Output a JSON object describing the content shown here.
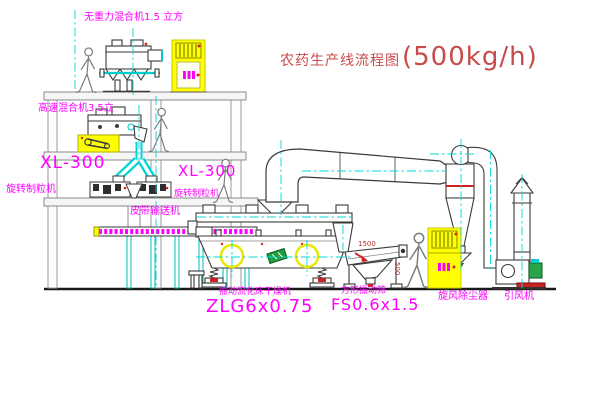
{
  "title": {
    "text": "农药生产线流程图",
    "capacity": "(500kg/h)"
  },
  "labels": {
    "gravity_mixer": "无重力混合机1.5 立方",
    "high_speed_mixer": "高速混合机3.5立",
    "granulator_left_model": "XL-300",
    "granulator_left_name": "旋转制粒机",
    "granulator_mid_model": "XL-300",
    "granulator_mid_name": "旋转制粒机",
    "belt_conveyor": "皮带输送机",
    "dryer_name": "振动流化床干燥机",
    "dryer_model": "ZLG6x0.75",
    "screen_name": "方形振动筛",
    "screen_model": "FS0.6x1.5",
    "cyclone": "旋风除尘器",
    "fan": "引风机"
  },
  "dimensions": {
    "screen_length": "1500",
    "screen_width": "500"
  },
  "colors": {
    "background": "#ffffff",
    "machine_line": "#3a3a3a",
    "frame_line": "#9a9a9a",
    "centerline_cyan": "#00d8d8",
    "cabinet_yellow": "#ffff00",
    "label_magenta": "#ff00ff",
    "accent_red": "#cc2222",
    "title_red": "#c84b4b",
    "motor_green": "#2aa34b"
  }
}
